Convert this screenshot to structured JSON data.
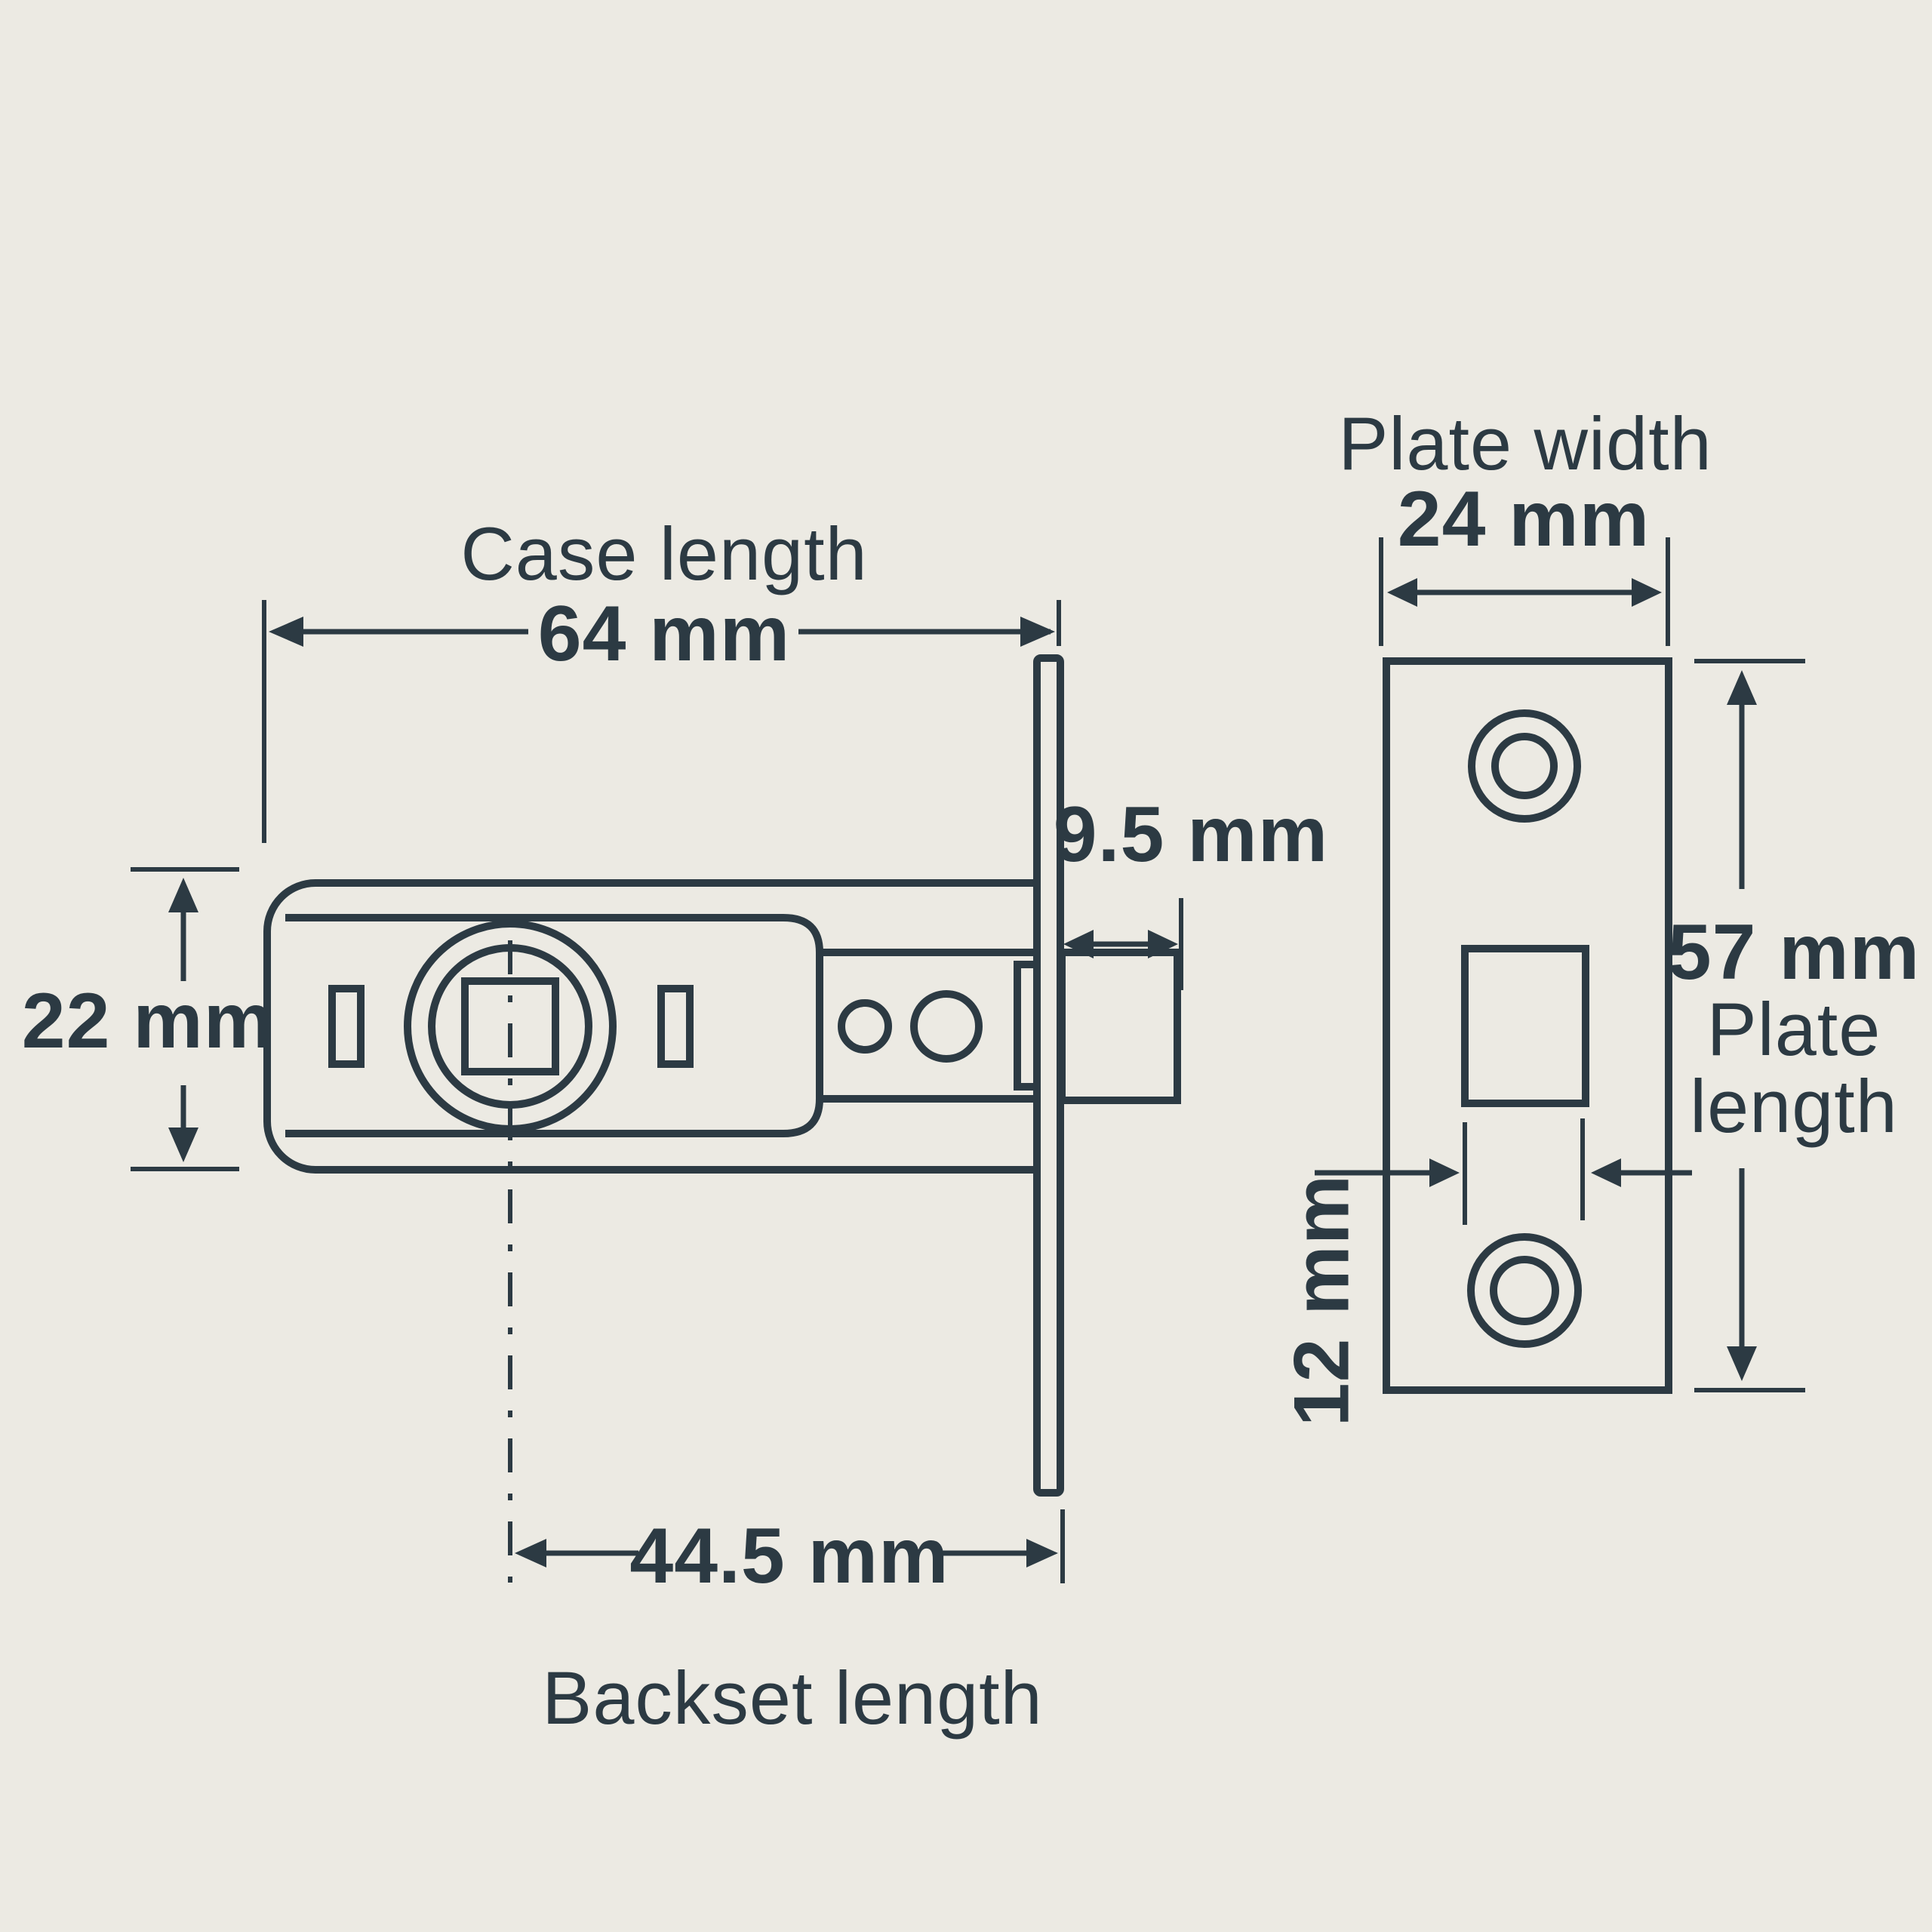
{
  "meta": {
    "title": "Tubular latch dimensions diagram",
    "background_color": "#ECEAE3",
    "ink_color": "#2C3A43"
  },
  "latch_side_view": {
    "case_length_label": "Case length",
    "case_length_value": "64 mm",
    "case_height_value": "22 mm",
    "bolt_projection_value": "9.5 mm",
    "backset_value": "44.5 mm",
    "backset_label": "Backset length"
  },
  "faceplate_front_view": {
    "plate_width_label": "Plate width",
    "plate_width_value": "24 mm",
    "plate_length_value": "57 mm",
    "plate_length_label_line1": "Plate",
    "plate_length_label_line2": "length",
    "aperture_width_value": "12 mm"
  }
}
